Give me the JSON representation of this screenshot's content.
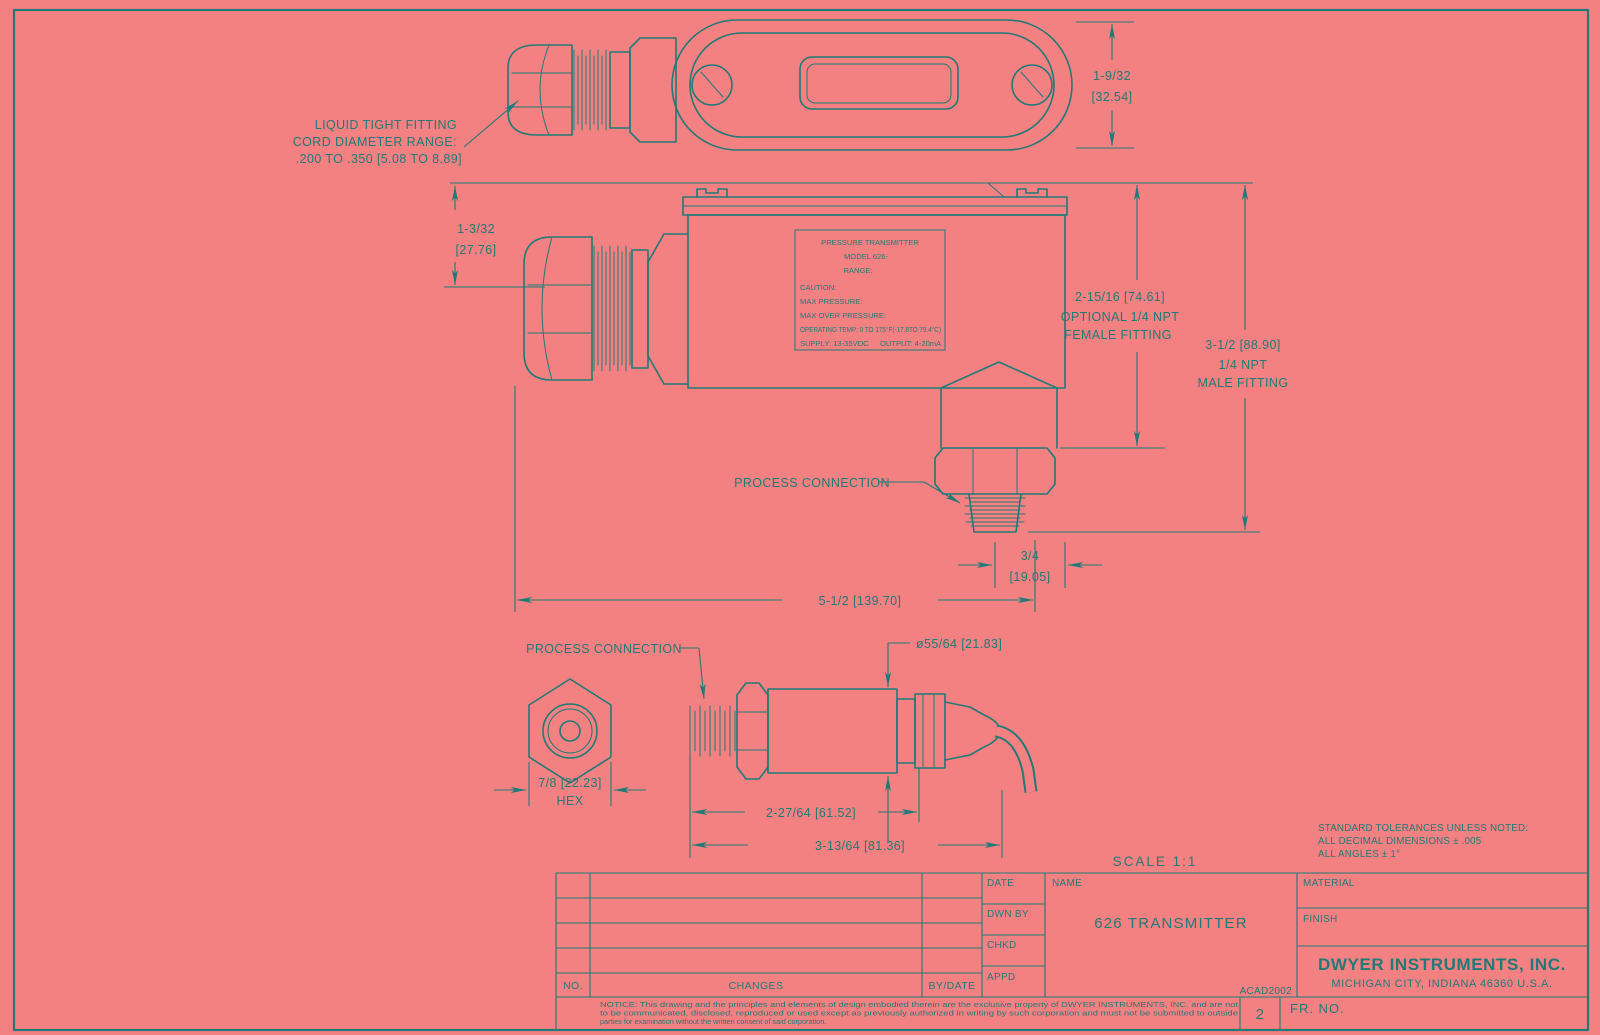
{
  "colors": {
    "background": "#f48181",
    "line": "#1f7a78"
  },
  "notes": {
    "liquid_tight": [
      "LIQUID TIGHT FITTING",
      "CORD DIAMETER RANGE:",
      ".200 TO .350 [5.08 TO 8.89]"
    ],
    "process_connection_side": "PROCESS CONNECTION",
    "process_connection_bottom": "PROCESS CONNECTION",
    "scale": "SCALE 1:1",
    "tolerances": [
      "STANDARD TOLERANCES UNLESS NOTED:",
      "ALL DECIMAL DIMENSIONS ± .005",
      "ALL ANGLES ± 1°"
    ]
  },
  "dimensions": {
    "cover_height": [
      "1-9/32",
      "[32.54]"
    ],
    "grip_offset": [
      "1-3/32",
      "[27.76]"
    ],
    "female_fitting": [
      "2-15/16 [74.61]",
      "OPTIONAL 1/4 NPT",
      "FEMALE FITTING"
    ],
    "male_fitting": [
      "3-1/2 [88.90]",
      "1/4 NPT",
      "MALE FITTING"
    ],
    "conn_offset": [
      "3/4",
      "[19.05]"
    ],
    "overall_width": "5-1/2 [139.70]",
    "probe_dia": "ø55/64 [21.83]",
    "hex_flats": [
      "7/8 [22.23]",
      "HEX"
    ],
    "probe_len1": "2-27/64 [61.52]",
    "probe_len2": "3-13/64 [81.36]"
  },
  "nameplate": {
    "line1": "PRESSURE TRANSMITTER",
    "line2": "MODEL 626-",
    "line3": "RANGE:",
    "line4": "CAUTION:",
    "line5": "MAX PRESSURE:",
    "line6": "MAX OVER PRESSURE:",
    "line7": "OPERATING TEMP: 0 TO 175°F(-17.8TO 79.4°C)",
    "supply": "SUPPLY: 13-35VDC",
    "output": "OUTPUT: 4-20mA"
  },
  "title_block": {
    "rev_no": "NO.",
    "rev_changes": "CHANGES",
    "rev_by_date": "BY/DATE",
    "sign_rows": [
      "DATE",
      "DWN BY",
      "CHKD",
      "APPD"
    ],
    "name_label": "NAME",
    "drawing_title": "626 TRANSMITTER",
    "material_label": "MATERIAL",
    "finish_label": "FINISH",
    "company": "DWYER INSTRUMENTS, INC.",
    "address": "MICHIGAN CITY, INDIANA 46360    U.S.A.",
    "cad_ref": "ACAD2002",
    "sheet": "2",
    "fr_no": "FR. NO.",
    "notice": [
      "NOTICE: This drawing and the principles and elements of design embodied therein are the exclusive property of DWYER INSTRUMENTS, INC. and are not",
      "to be communicated, disclosed, reproduced or used except as previously authorized in writing by such corporation and must not be submitted to outside",
      "parties for examination without the written consent of said corporation."
    ]
  }
}
